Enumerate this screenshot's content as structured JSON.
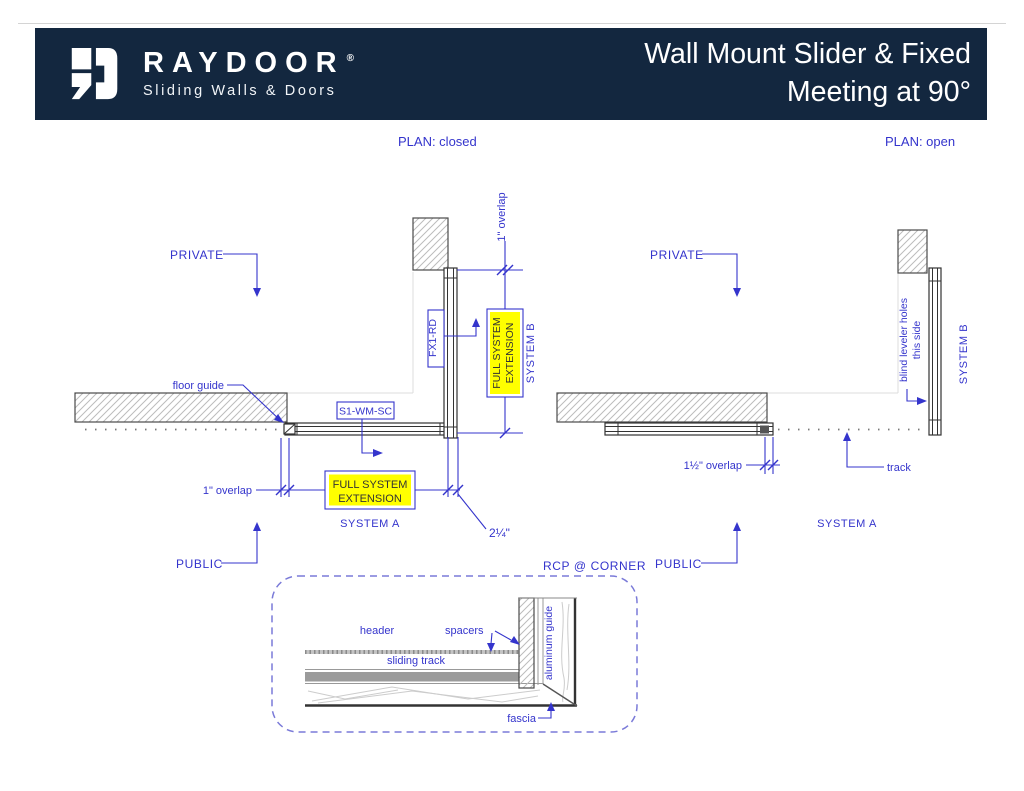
{
  "header": {
    "brand": "RAYDOOR",
    "registered_mark": "®",
    "tagline": "Sliding Walls & Doors",
    "title_line1": "Wall Mount Slider & Fixed",
    "title_line2": "Meeting at 90°"
  },
  "colors": {
    "header_bg": "#13273f",
    "annotation_blue": "#3434cc",
    "highlight_yellow": "#ffff00"
  },
  "plan_closed": {
    "caption": "PLAN: closed",
    "private_label": "PRIVATE",
    "public_label": "PUBLIC",
    "floor_guide_label": "floor guide",
    "fixed_panel_model": "FX1-RD",
    "slider_model": "S1-WM-SC",
    "overlap_top": "1\" overlap",
    "overlap_bottom": "1\" overlap",
    "full_system_extension_line1": "FULL SYSTEM",
    "full_system_extension_line2": "EXTENSION",
    "system_a": "SYSTEM A",
    "system_b": "SYSTEM B",
    "corner_dimension": "2¼\""
  },
  "plan_open": {
    "caption": "PLAN: open",
    "private_label": "PRIVATE",
    "public_label": "PUBLIC",
    "blind_leveler_line1": "blind leveler holes",
    "blind_leveler_line2": "this side",
    "overlap": "1½\" overlap",
    "track_label": "track",
    "system_a": "SYSTEM A",
    "system_b": "SYSTEM B"
  },
  "rcp_detail": {
    "caption": "RCP @ CORNER",
    "header_label": "header",
    "spacers_label": "spacers",
    "sliding_track_label": "sliding track",
    "aluminum_guide_label": "aluminum guide",
    "fascia_label": "fascia"
  }
}
